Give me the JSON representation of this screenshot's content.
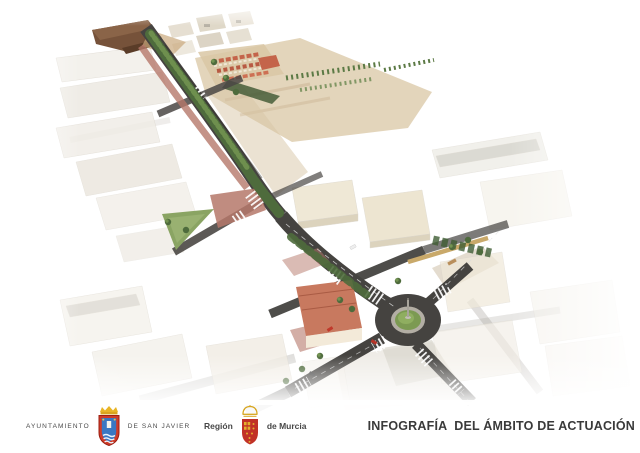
{
  "scene": {
    "type": "3d-aerial-render",
    "subject": "tree-lined avenue redevelopment through town with roundabout"
  },
  "footer": {
    "ayuntamiento_left": "AYUNTAMIENTO",
    "ayuntamiento_right": "DE SAN JAVIER",
    "region_left": "Región",
    "region_right": "de Murcia",
    "title": "INFOGRAFÍA  DEL ÁMBITO DE ACTUACIÓN"
  },
  "icons": {
    "san_javier": "san-javier-coat-of-arms",
    "murcia": "murcia-coat-of-arms"
  },
  "colors": {
    "asphalt": "#454340",
    "tree_green": "#4e6b3c",
    "plaza_green": "#8aa463",
    "farmland_tan": "#d9c7a4",
    "brick_paving": "#b5786a",
    "terracotta_roof": "#c8795f",
    "canopy_brown": "#76523a",
    "building_cream": "#efe9dc",
    "crest_red": "#cf3b28",
    "crest_gold": "#e3b02c",
    "crest_blue": "#3a77c2",
    "title_text": "#3a3a3a"
  }
}
